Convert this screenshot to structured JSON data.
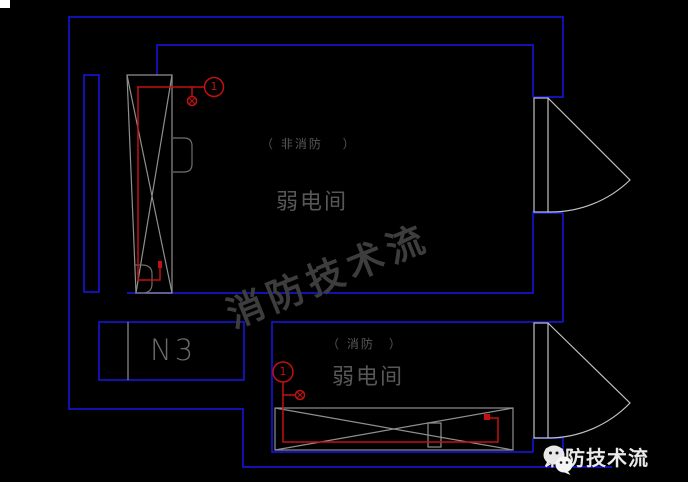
{
  "colors": {
    "bg": "#000000",
    "wall-blue": "#1414cc",
    "circuit-red": "#c31111",
    "line-gray": "#8f8f8f",
    "line-gray2": "#6f6f6f",
    "door-gray": "#c2c2c2",
    "label-gray": "#575757",
    "watermark-gray": "#3d3d3d",
    "logo-white": "#e9e9e9"
  },
  "rooms": {
    "top": {
      "type_label": "（ 非消防　 ）",
      "name": "弱电间",
      "circuit_number": "1"
    },
    "bottom": {
      "type_label": "（ 消防　）",
      "name": "弱电间",
      "circuit_number": "1"
    }
  },
  "panel": {
    "label": "N3"
  },
  "watermark": {
    "text": "消防技术流"
  },
  "logo": {
    "text": "消防技术流",
    "icon": "wechat-icon"
  }
}
